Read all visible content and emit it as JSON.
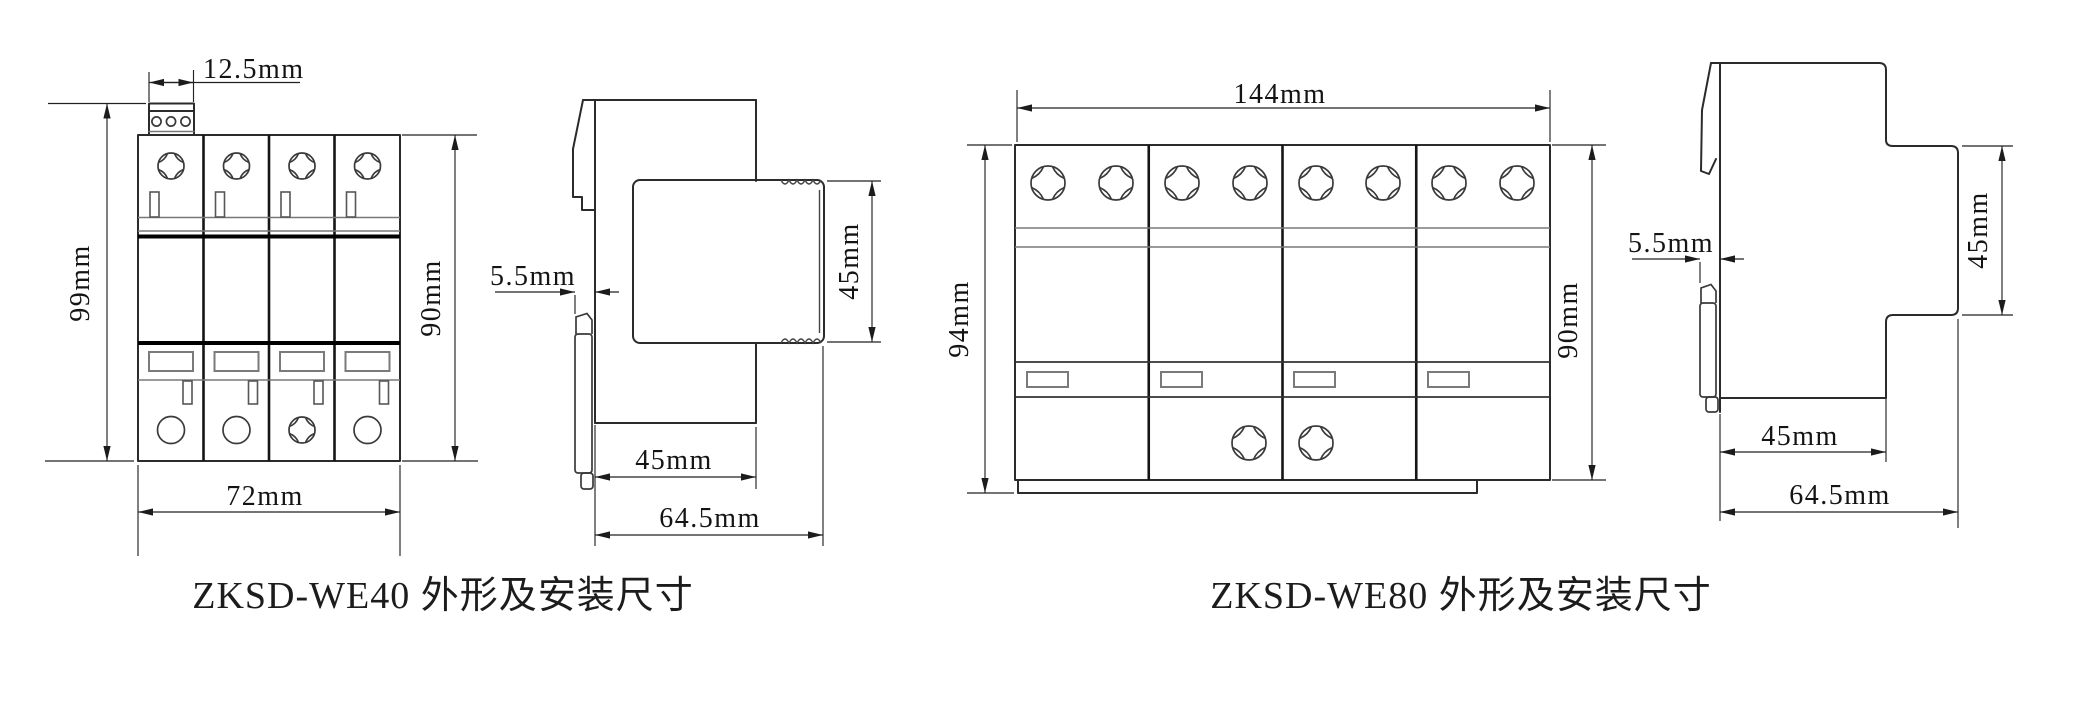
{
  "page": {
    "background": "#ffffff",
    "line_color": "#2b2b2b",
    "type": "technical-dimension-drawing"
  },
  "drawings": {
    "we40": {
      "caption": "ZKSD-WE40 外形及安装尺寸",
      "front": {
        "terminal_width": "12.5mm",
        "overall_height": "99mm",
        "body_height": "90mm",
        "width": "72mm"
      },
      "side": {
        "rail_offset": "5.5mm",
        "front_height": "45mm",
        "body_depth": "45mm",
        "overall_depth": "64.5mm"
      }
    },
    "we80": {
      "caption": "ZKSD-WE80 外形及安装尺寸",
      "front": {
        "width": "144mm",
        "overall_height": "94mm",
        "body_height": "90mm"
      },
      "side": {
        "rail_offset": "5.5mm",
        "front_height": "45mm",
        "body_depth": "45mm",
        "overall_depth": "64.5mm"
      }
    }
  }
}
